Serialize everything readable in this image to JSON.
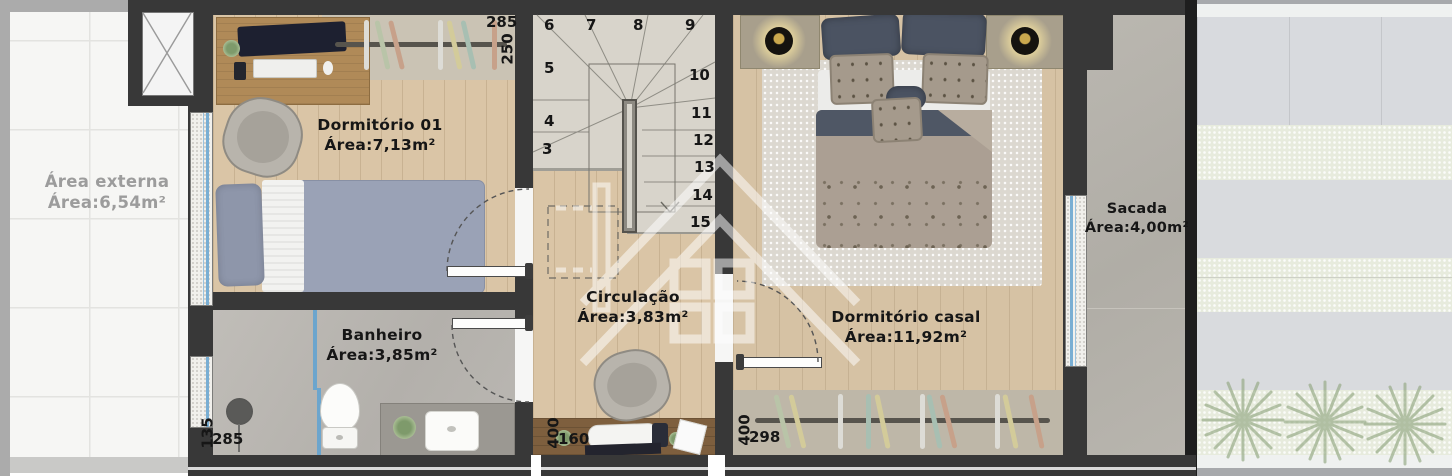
{
  "rooms": {
    "area_externa": {
      "name": "Área externa",
      "area": "Área:6,54m²"
    },
    "dormitorio_01": {
      "name": "Dormitório 01",
      "area": "Área:7,13m²"
    },
    "banheiro": {
      "name": "Banheiro",
      "area": "Área:3,85m²"
    },
    "circulacao": {
      "name": "Circulação",
      "area": "Área:3,83m²"
    },
    "dormitorio_casal": {
      "name": "Dormitório casal",
      "area": "Área:11,92m²"
    },
    "sacada": {
      "name": "Sacada",
      "area": "Área:4,00m²"
    }
  },
  "stairs": {
    "steps": [
      "3",
      "4",
      "5",
      "6",
      "7",
      "8",
      "9",
      "10",
      "11",
      "12",
      "13",
      "14",
      "15"
    ]
  },
  "dimensions": {
    "dorm01_top_width": "285",
    "dorm01_closet_depth": "250",
    "banheiro_left_a": "135",
    "banheiro_left_b": "285",
    "circulacao_left_a": "400",
    "circulacao_left_b": "160",
    "casal_closet_a": "400",
    "casal_closet_b": "298"
  },
  "icons": {
    "watermark": "house-logo"
  },
  "colors": {
    "wall": "#383838",
    "wood": "#dac5a6",
    "exterior_tile": "#f6f6f4",
    "bath_floor": "#b8b5b0",
    "stair_floor": "#d8d4cb",
    "concrete": "#b5b2ab",
    "outdoor_tile": "#d8dade",
    "grass": "#e7ebdd",
    "window_glass": "#79aed3",
    "watermark": "#ffffff"
  }
}
